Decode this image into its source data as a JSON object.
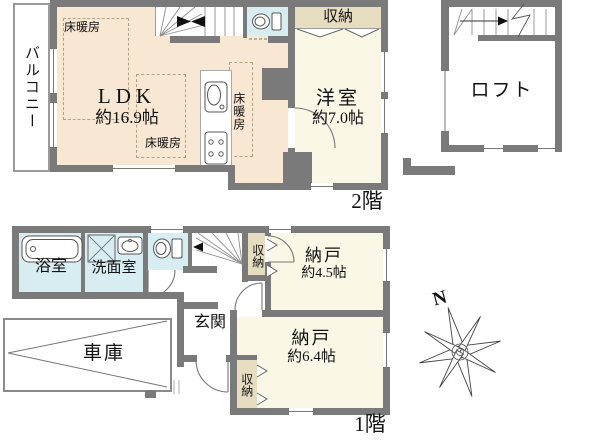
{
  "colors": {
    "wall": "#7a7a7a",
    "ldk_fill": "#f8e7d2",
    "room_fill": "#faf7e6",
    "closet_fill": "#e6dcbf",
    "wet_fill": "#d8edf2"
  },
  "floor2": {
    "floor_label": "2階",
    "balcony_label": "バルコニー",
    "ldk_name": "LDK",
    "ldk_size": "約16.9帖",
    "floor_heating": [
      "床暖房",
      "床暖房",
      "床暖房"
    ],
    "closet_label": "収納",
    "western_room_name": "洋室",
    "western_room_size": "約7.0帖",
    "loft_label": "ロフト"
  },
  "floor1": {
    "floor_label": "1階",
    "bathroom_label": "浴室",
    "washroom_label": "洗面室",
    "closet_top_label": "収納",
    "storage_a_name": "納戸",
    "storage_a_size": "約4.5帖",
    "storage_b_name": "納戸",
    "storage_b_size": "約6.4帖",
    "entrance_label": "玄関",
    "garage_label": "車庫",
    "closet_bottom_label": "収納"
  },
  "compass": {
    "north_label": "N"
  }
}
